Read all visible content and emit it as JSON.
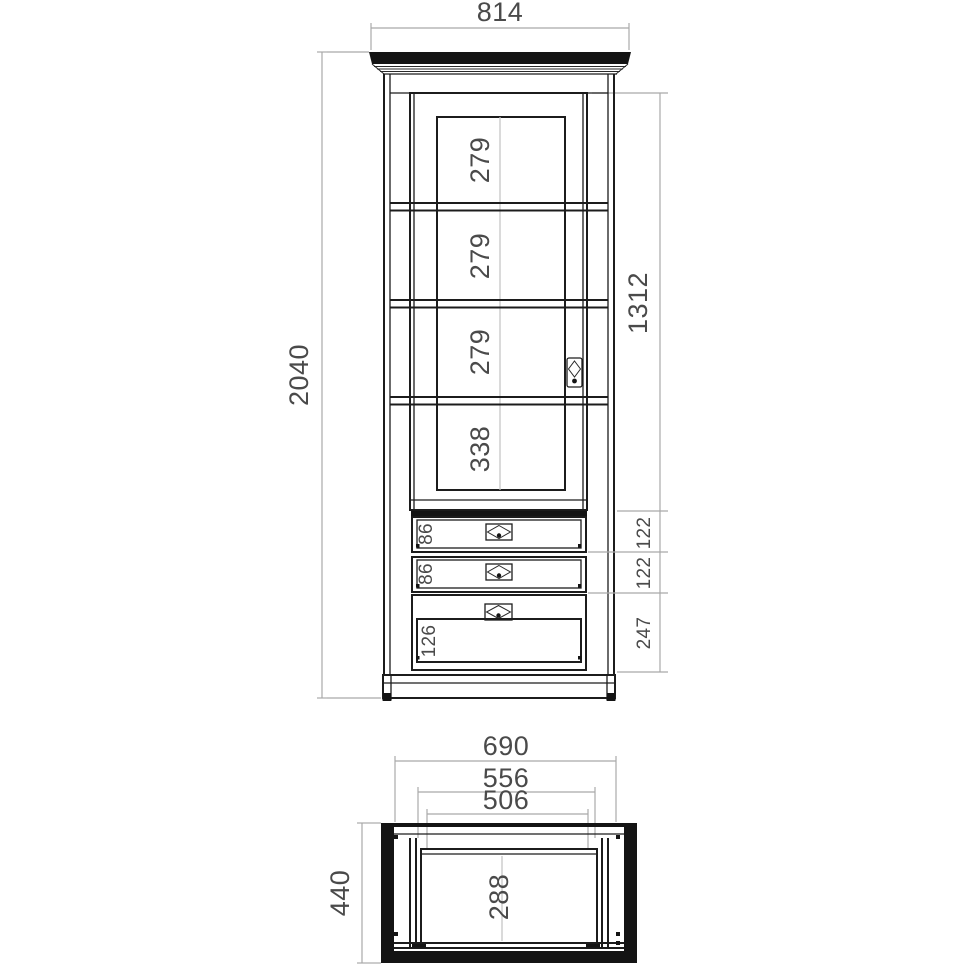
{
  "front_view": {
    "overall_width_mm": "814",
    "overall_height_mm": "2040",
    "door_opening_height_mm": "1312",
    "shelf_gaps": [
      "279",
      "279",
      "279",
      "338"
    ],
    "drawer_inner_heights": [
      "86",
      "86",
      "126"
    ],
    "drawer_outer_heights": [
      "122",
      "122",
      "247"
    ]
  },
  "top_view": {
    "carcass_width_mm": "690",
    "mid_width_mm": "556",
    "inner_width_mm": "506",
    "overall_depth_mm": "440",
    "inner_depth_mm": "288"
  },
  "colors": {
    "line": "#1c1c1c",
    "dimension_line": "#a9a9a9",
    "dimension_text": "#4a4a4a",
    "background": "#ffffff"
  }
}
